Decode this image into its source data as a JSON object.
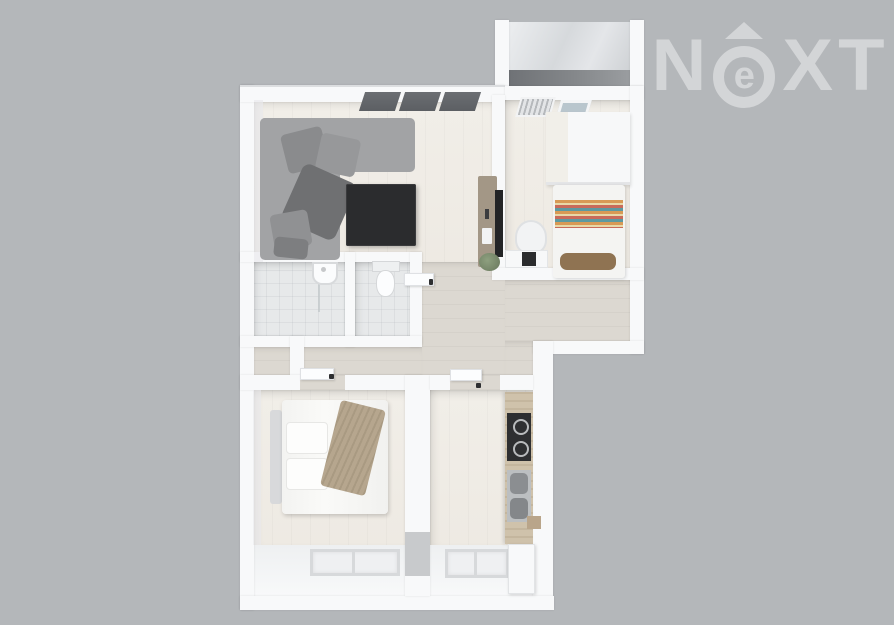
{
  "canvas": {
    "width": 894,
    "height": 625
  },
  "background_color": "#b4b7ba",
  "logo": {
    "word": "NEXT",
    "letter_n": "N",
    "letter_e": "e",
    "letter_x": "X",
    "letter_t": "T",
    "color": "rgba(255,255,255,0.42)",
    "style": "white translucent wordmark, stylized E inside ring with roof triangle above"
  },
  "floorplan": {
    "type": "3d-top-down-apartment-render",
    "rooms": [
      {
        "name": "living-room",
        "furniture": [
          "corner-sofa",
          "scatter-cushions",
          "coffee-table",
          "tv-sideboard",
          "wall-tv",
          "plant",
          "ceiling-window-band"
        ]
      },
      {
        "name": "small-bedroom",
        "furniture": [
          "single-bed",
          "striped-blanket",
          "brown-pillow",
          "wardrobe",
          "desk",
          "desk-chair",
          "skylight-louver",
          "skylight-glass"
        ]
      },
      {
        "name": "bathroom",
        "furniture": [
          "washbasin",
          "shower-screen"
        ]
      },
      {
        "name": "wc",
        "furniture": [
          "toilet"
        ]
      },
      {
        "name": "hallway",
        "furniture": [
          "open-door-leaves"
        ]
      },
      {
        "name": "main-bedroom",
        "furniture": [
          "double-bed",
          "headboard",
          "pillows",
          "beige-throw",
          "window"
        ]
      },
      {
        "name": "kitchen",
        "furniture": [
          "counter",
          "cooktop",
          "double-sink",
          "cabinet",
          "window"
        ]
      },
      {
        "name": "balcony",
        "furniture": [
          "dark-window-band"
        ]
      }
    ],
    "colors": {
      "wall": "#f8f9fa",
      "wood_floor_light": "#eeeae3",
      "wood_floor_hall": "#dcd8d1",
      "tile_floor": "#e7e9ea",
      "sofa_gray": "#a2a3a5",
      "sofa_dark": "#77787a",
      "coffee_table": "#2b2c2e",
      "window_dark": "#63666a",
      "counter_wood": "#cfc2ab",
      "sideboard_brown": "#a39786",
      "stripe_orange": "#d89a55",
      "stripe_red": "#c96b5a",
      "stripe_teal": "#5d9aa0",
      "stripe_cream": "#e8d9a8",
      "throw_beige": "#b6a68e",
      "pillow_brown": "#8f7352",
      "plant_green": "#7b8b6f"
    }
  }
}
